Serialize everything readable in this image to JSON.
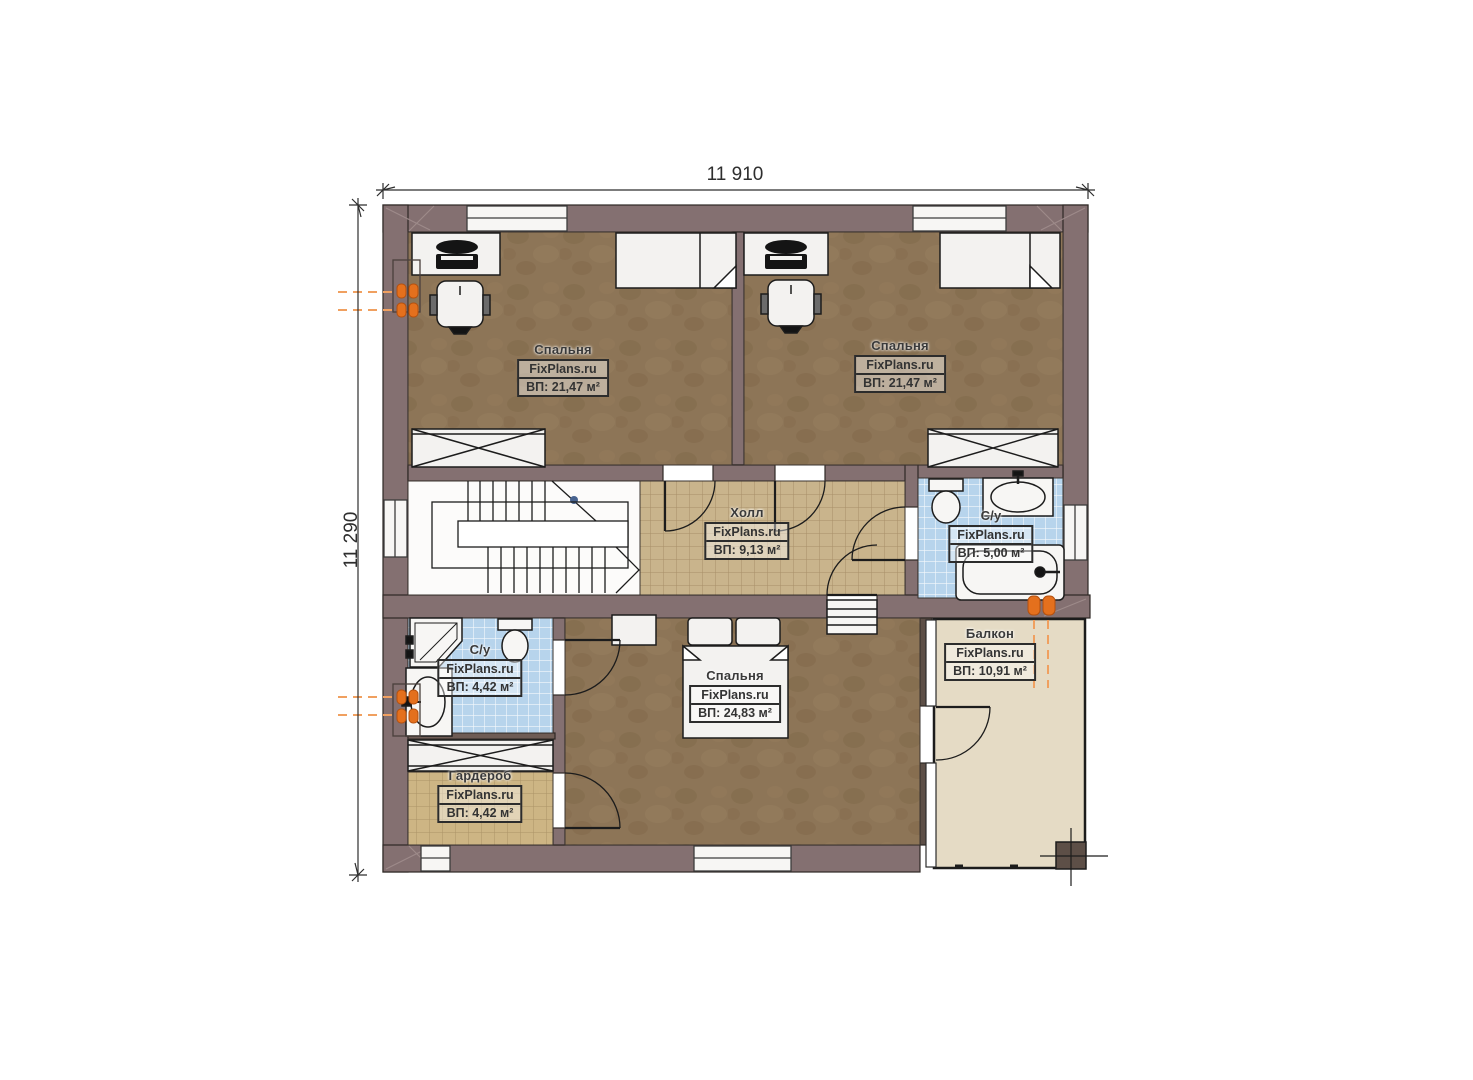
{
  "brand": "FixPlans.ru",
  "dimensions": {
    "top": "11 910",
    "left": "11 290"
  },
  "rooms": [
    {
      "key": "bedroom_top_left",
      "name": "Спальня",
      "area": "ВП: 21,47 м²"
    },
    {
      "key": "bedroom_top_right",
      "name": "Спальня",
      "area": "ВП: 21,47 м²"
    },
    {
      "key": "hall",
      "name": "Холл",
      "area": "ВП: 9,13 м²"
    },
    {
      "key": "bathroom_middle",
      "name": "С/у",
      "area": "ВП: 5,00 м²"
    },
    {
      "key": "bathroom_bottom",
      "name": "С/у",
      "area": "ВП: 4,42 м²"
    },
    {
      "key": "bedroom_bottom",
      "name": "Спальня",
      "area": "ВП: 24,83 м²"
    },
    {
      "key": "wardrobe",
      "name": "Гардероб",
      "area": "ВП: 4,42 м²"
    },
    {
      "key": "balcony",
      "name": "Балкон",
      "area": "ВП: 10,91 м²"
    }
  ],
  "colors": {
    "wall": "#847071",
    "wall_dark": "#5d4f47",
    "carpet": "#8d7557",
    "tile_tan": "#c9b48c",
    "tile_blue": "#b7d4ec",
    "balcony_floor": "#e5dbc5",
    "radiator": "#e4701d"
  }
}
